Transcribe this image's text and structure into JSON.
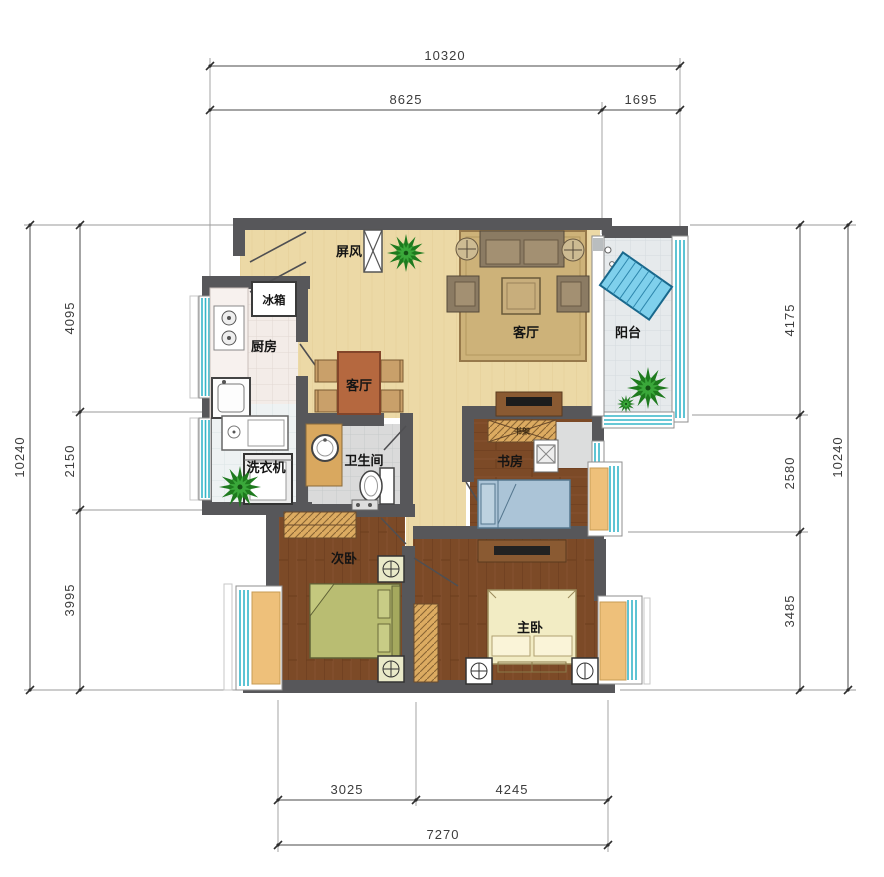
{
  "plan": {
    "type": "apartment-floor-plan",
    "dimensions": {
      "top": {
        "overall": "10320",
        "seg1": "8625",
        "seg2": "1695"
      },
      "left": {
        "overall": "10240",
        "seg1": "4095",
        "seg2": "2150",
        "seg3": "3995"
      },
      "right": {
        "overall": "10240",
        "seg1": "4175",
        "seg2": "2580",
        "seg3": "3485"
      },
      "bottom": {
        "overall": "7270",
        "seg1": "3025",
        "seg2": "4245"
      }
    },
    "labels": {
      "screen": "屏风",
      "fridge": "冰箱",
      "kitchen": "厨房",
      "dining": "客厅",
      "living": "客厅",
      "balcony": "阳台",
      "laundry": "洗衣机",
      "bathroom": "卫生间",
      "study": "书房",
      "bookshelf": "书架",
      "bedroom2": "次卧",
      "master": "主卧"
    },
    "colors": {
      "wall": "#57575a",
      "floor_living": "#ecd9a6",
      "floor_wood": "#7c4a27",
      "floor_kitchen": "#f3ece8",
      "floor_laundry": "#eef2f3",
      "floor_bath": "#dadada",
      "floor_balcony": "#e6eaec",
      "window_glass": "#35b6c9",
      "bay_curtain": "#eec07a",
      "dining_table": "#b5683f",
      "bed_green": "#b9bd72",
      "bed_cream": "#f2ecc4",
      "bed_blue": "#abc4d7",
      "lounge_chair": "#7fd0ec",
      "plant": "#1e7a1e",
      "wardrobe": "#dcab61"
    }
  }
}
